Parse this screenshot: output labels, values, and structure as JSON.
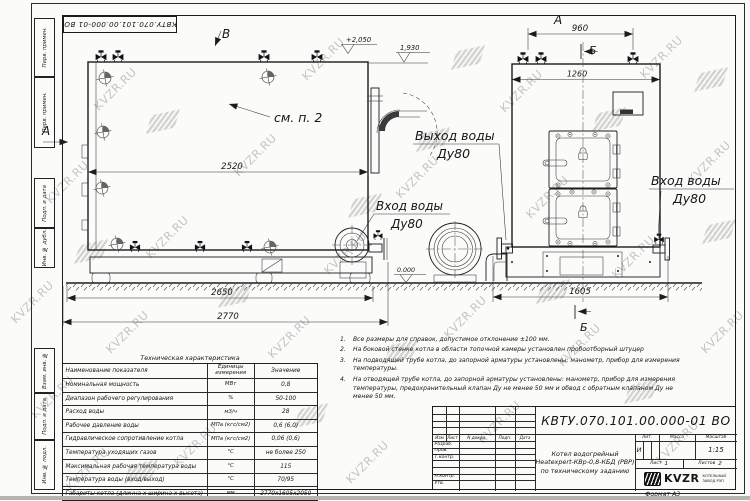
{
  "doc": {
    "number": "КВТУ.070.101.00.000-01 ВО",
    "format": "Формат А3"
  },
  "watermark": {
    "text": "KVZR.RU",
    "text_positions": [
      [
        5,
        295
      ],
      [
        25,
        390
      ],
      [
        40,
        175
      ],
      [
        88,
        82
      ],
      [
        100,
        325
      ],
      [
        140,
        230
      ],
      [
        168,
        438
      ],
      [
        228,
        148
      ],
      [
        262,
        330
      ],
      [
        296,
        52
      ],
      [
        318,
        246
      ],
      [
        340,
        455
      ],
      [
        390,
        170
      ],
      [
        438,
        310
      ],
      [
        472,
        415
      ],
      [
        494,
        84
      ],
      [
        520,
        190
      ],
      [
        552,
        338
      ],
      [
        606,
        250
      ],
      [
        634,
        50
      ],
      [
        650,
        435
      ],
      [
        682,
        155
      ],
      [
        695,
        325
      ],
      [
        60,
        462
      ]
    ],
    "logo_positions": [
      [
        150,
        112
      ],
      [
        78,
        242
      ],
      [
        222,
        286
      ],
      [
        298,
        406
      ],
      [
        388,
        342
      ],
      [
        420,
        130
      ],
      [
        455,
        48
      ],
      [
        540,
        282
      ],
      [
        596,
        110
      ],
      [
        628,
        382
      ],
      [
        698,
        70
      ],
      [
        706,
        222
      ],
      [
        128,
        462
      ],
      [
        352,
        196
      ]
    ]
  },
  "margin": {
    "labels": [
      "Перв. примен.",
      "Перв. примен.",
      "Подп. и дата",
      "Инв. № дубл.",
      "Взам. инв. №",
      "Подп. и дата",
      "Инв. № подл."
    ]
  },
  "views": {
    "label_a": "А",
    "label_b": "Б",
    "label_v": "В",
    "see_note": "см. п. 2"
  },
  "dims": {
    "side_mid": "2520",
    "side_base": "2650",
    "side_total": "2770",
    "front_top": "960",
    "front_width": "1260",
    "front_base": "1605",
    "elev_top": "+2,050",
    "elev_mid": "1,930",
    "elev_zero": "0.000"
  },
  "ports": {
    "outlet_line1": "Выход воды",
    "outlet_line2": "Ду80",
    "inlet_line1": "Вход воды",
    "inlet_line2": "Ду80"
  },
  "table": {
    "title": "Техническая характеристика",
    "headers": [
      "Наименование показателя",
      "Единицы измерения",
      "Значение"
    ],
    "rows": [
      [
        "Номинальная мощность",
        "МВт",
        "0,8"
      ],
      [
        "Диапазон рабочего регулирования",
        "%",
        "50-100"
      ],
      [
        "Расход воды",
        "м3/ч",
        "28"
      ],
      [
        "Рабочее давление воды",
        "МПа (кгс/см2)",
        "0,6 (6,0)"
      ],
      [
        "Гидравлическое сопротивление котла",
        "МПа (кгс/см2)",
        "0,06 (0,6)"
      ],
      [
        "Температура уходящих газов",
        "°С",
        "не более 250"
      ],
      [
        "Максимальная рабочая температура воды",
        "°С",
        "115"
      ],
      [
        "Температура воды (вход/выход)",
        "°С",
        "70/95"
      ],
      [
        "Габариты котла (длинна х ширина х высота)",
        "мм",
        "2770х1605х2050"
      ]
    ]
  },
  "notes": {
    "items": [
      {
        "n": "1.",
        "t": "Все размеры для справок, допустимое отклонение ±100 мм."
      },
      {
        "n": "2.",
        "t": "На боковой стенке котла в области топочной камеры установлен пробоотборный штуцер"
      },
      {
        "n": "3.",
        "t": "На подводящей трубе котла, до запорной арматуры установлены: манометр, прибор для измерения температуры."
      },
      {
        "n": "4.",
        "t": "На отводящей трубе котла, до запорной арматуры установлены: манометр, прибор для измерения температуры, предохранительный клапан Ду не менее 50 мм и обвод с обратным клапаном Ду не менее 50 мм."
      }
    ]
  },
  "titleblock": {
    "header_izm": "Изм",
    "header_list": "Лист",
    "header_ndoc": "N докум.",
    "header_podp": "Подп.",
    "header_data": "Дата",
    "razrab": "Разраб.",
    "prov": "Пров.",
    "tkontr": "Т.контр.",
    "nkontr": "Н.контр.",
    "utv": "Утв.",
    "name_line1": "Котел водогрейный",
    "name_line2": "Heatexpert-КВр-0,8-КБД (РВР)",
    "name_line3": "по техническому заданию",
    "lit_label": "Лит.",
    "lit_value": "И",
    "mass_label": "Масса",
    "scale_label": "Масштаб",
    "scale_value": "1:15",
    "sheet_label": "Лист",
    "sheet_value": "1",
    "sheets_label": "Листов",
    "sheets_value": "2",
    "logo_text": "KVZR",
    "logo_sub1": "КОТЕЛЬНЫЙ",
    "logo_sub2": "ЗАВОД РЭП"
  }
}
